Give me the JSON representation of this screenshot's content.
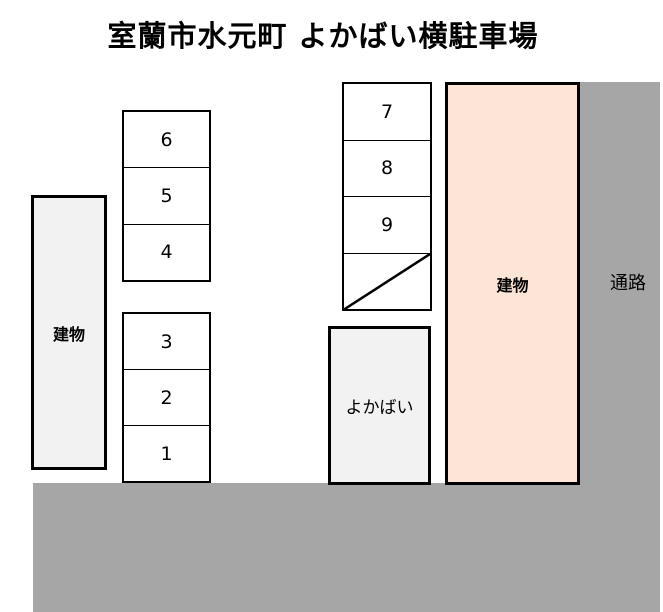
{
  "title": "室蘭市水元町 よかばい横駐車場",
  "buildings": {
    "left": {
      "label": "建物"
    },
    "right": {
      "label": "建物"
    }
  },
  "yokabai": {
    "label": "よかばい"
  },
  "road": {
    "label": "通路"
  },
  "parking": {
    "left_upper": {
      "cells": [
        "6",
        "5",
        "4"
      ]
    },
    "left_lower": {
      "cells": [
        "3",
        "2",
        "1"
      ]
    },
    "middle": {
      "cells": [
        "7",
        "8",
        "9"
      ],
      "blocked_cell_marker": "diagonal-line"
    }
  },
  "colors": {
    "road_fill": "#a6a6a6",
    "building_left_fill": "#f2f2f2",
    "building_right_fill": "#fce4d6",
    "yokabai_fill": "#f2f2f2",
    "spot_fill": "#ffffff",
    "border": "#000000",
    "text": "#000000"
  }
}
